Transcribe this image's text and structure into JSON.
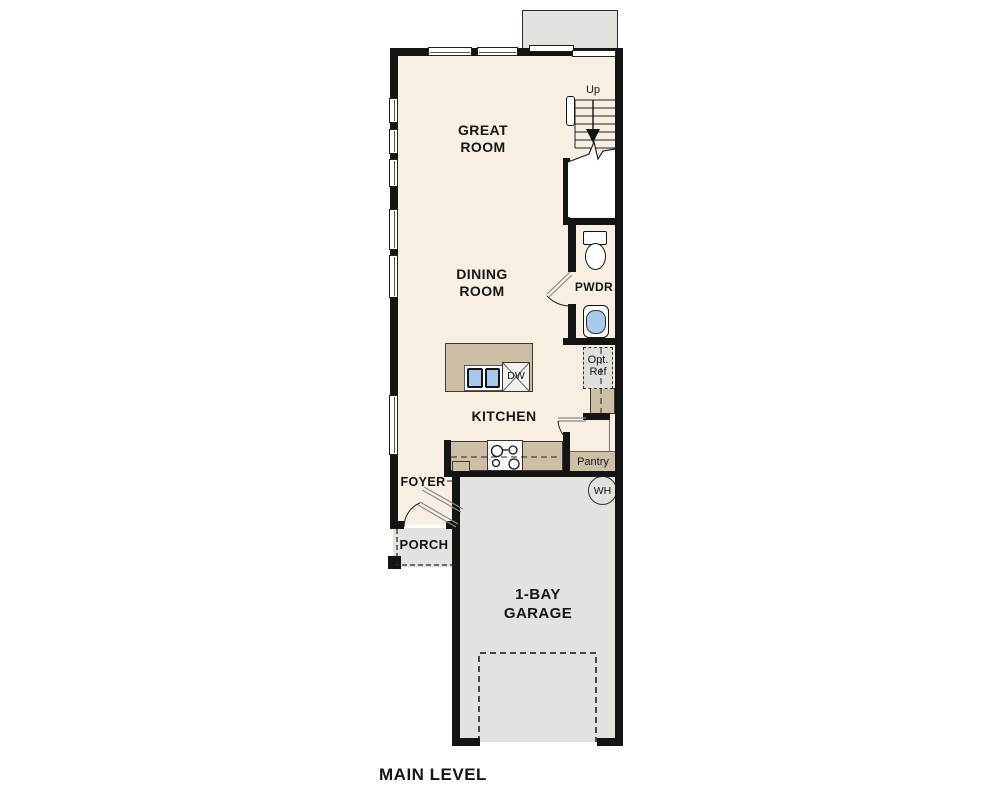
{
  "title": "MAIN LEVEL",
  "rooms": {
    "great_room": {
      "line1": "GREAT",
      "line2": "ROOM"
    },
    "dining_room": {
      "line1": "DINING",
      "line2": "ROOM"
    },
    "kitchen": {
      "label": "KITCHEN"
    },
    "foyer": {
      "label": "FOYER"
    },
    "porch": {
      "label": "PORCH"
    },
    "garage": {
      "line1": "1-BAY",
      "line2": "GARAGE"
    },
    "powder_room": {
      "label": "PWDR"
    },
    "pantry": {
      "label": "Pantry"
    }
  },
  "fixtures": {
    "dishwasher": "DW",
    "water_heater": "WH",
    "optional_refrigerator": {
      "line1": "Opt.",
      "line2": "Ref"
    }
  },
  "stairs": {
    "direction_label": "Up"
  },
  "colors": {
    "floor": "#f7efe2",
    "casework": "#cdbfa6",
    "concrete": "#e3e2df",
    "sink_blue": "#a9c8e9",
    "wall": "#141414"
  }
}
